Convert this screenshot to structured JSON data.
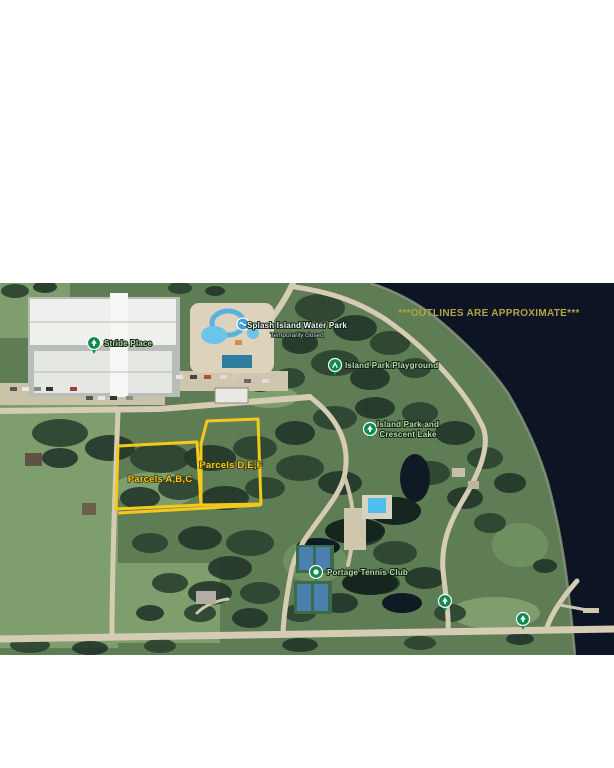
{
  "disclaimer": "***OUTLINES ARE APPROXIMATE***",
  "parcels": {
    "abc_label": "Parcels A,B,C",
    "def_label": "Parcels D,E,F"
  },
  "pois": {
    "stride_place": "Stride Place",
    "splash_island": "Splash Island Water Park",
    "splash_island_status": "Temporarily closed",
    "island_park_playground": "Island Park Playground",
    "island_park_line1": "Island Park and",
    "island_park_line2": "Crescent Lake",
    "portage_tennis": "Portage Tennis Club"
  },
  "colors": {
    "water": "#0d1524",
    "parcel_yellow": "#f5c91c",
    "disclaimer_gold": "#b4a245",
    "pin_green": "#0f8a4f",
    "label_green": "#b9d8a2",
    "label_white": "#f2f2f2",
    "label_gray": "#d9d9d9",
    "splash_icon_blue": "#3f9fd8"
  }
}
